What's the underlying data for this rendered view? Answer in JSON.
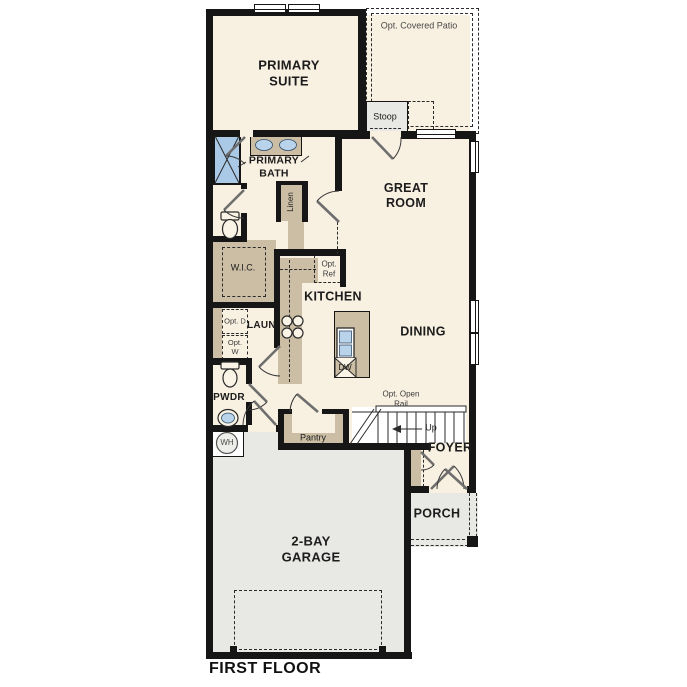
{
  "plan_title": "FIRST FLOOR",
  "colors": {
    "floor": "#f8f0e1",
    "wall": "#161616",
    "cabinet": "#cbbea4",
    "concrete": "#e8e8e5",
    "shower": "#aac9e6",
    "fixture": "#b9d3ea",
    "text": "#1c1c1c",
    "line": "#2a2a2a"
  },
  "rooms": {
    "primary_suite": {
      "label": "PRIMARY SUITE"
    },
    "primary_bath": {
      "label": "PRIMARY BATH"
    },
    "wic": {
      "label": "W.I.C."
    },
    "linen": {
      "label": "Linen"
    },
    "great_room": {
      "label": "GREAT ROOM"
    },
    "kitchen": {
      "label": "KITCHEN"
    },
    "dining": {
      "label": "DINING"
    },
    "laundry": {
      "label": "LAUN."
    },
    "powder": {
      "label": "PWDR"
    },
    "pantry": {
      "label": "Pantry"
    },
    "foyer": {
      "label": "FOYER"
    },
    "porch": {
      "label": "PORCH"
    },
    "garage": {
      "label": "2-BAY GARAGE"
    },
    "stoop": {
      "label": "Stoop"
    },
    "patio": {
      "label": "Opt. Covered Patio"
    }
  },
  "annotations": {
    "opt_ref": "Opt. Ref",
    "opt_dryer": "Opt. D",
    "opt_washer": "Opt. W",
    "dishwasher": "DW",
    "water_heater": "WH",
    "opt_open_rail": "Opt. Open Rail",
    "stairs_up": "Up"
  },
  "footer": {
    "label": "FIRST FLOOR"
  }
}
